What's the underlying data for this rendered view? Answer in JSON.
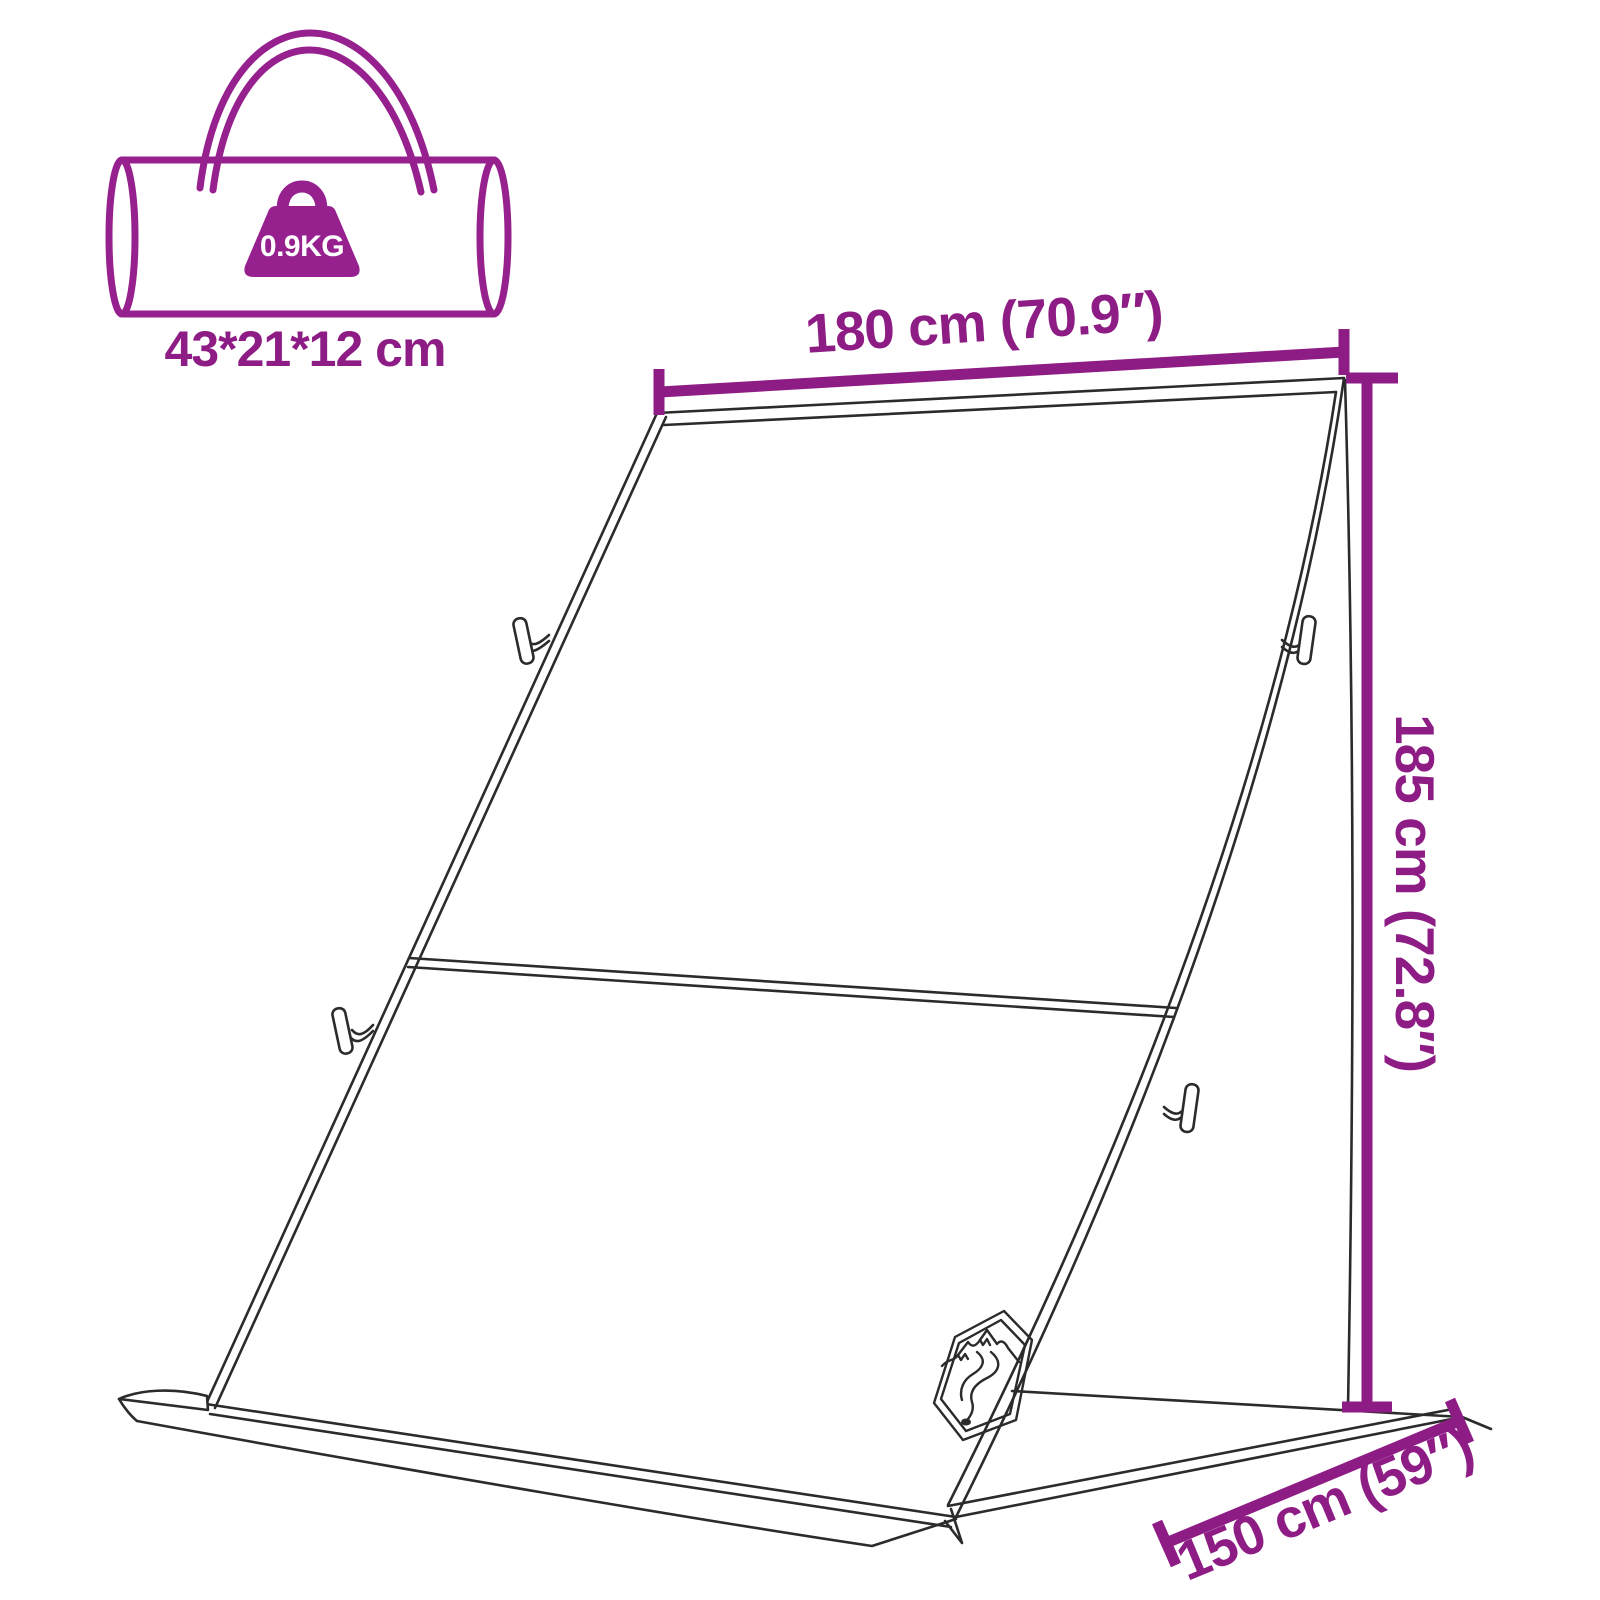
{
  "colors": {
    "accent": "#8E1C85",
    "icon": "#97208F",
    "line": "#2B2B2B",
    "background": "#FFFFFF",
    "weight_text": "#FFFFFF"
  },
  "package_icon": {
    "weight": "0.9KG",
    "size": "43*21*12 cm"
  },
  "dimension_labels": {
    "width": "180 cm (70.9″)",
    "height": "185 cm (72.8″)",
    "depth": "150 cm (59″)"
  },
  "icons": {
    "carry_bag": "carry-bag-icon",
    "weight": "weight-icon",
    "logo": "mountain-river-logo-icon",
    "toggle": "toggle-clip-icon"
  }
}
